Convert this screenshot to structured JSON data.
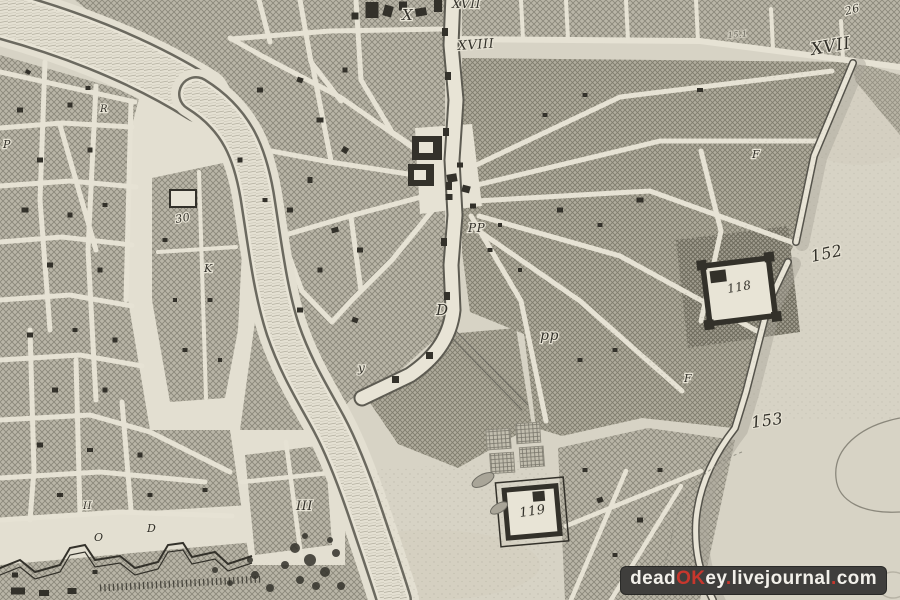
{
  "map": {
    "labels": [
      {
        "text": "X",
        "x": 402,
        "y": 20,
        "size": 15,
        "rot": 0
      },
      {
        "text": "XVII",
        "x": 452,
        "y": 8,
        "size": 12,
        "rot": 0
      },
      {
        "text": "XVIII",
        "x": 458,
        "y": 50,
        "size": 13,
        "rot": -4
      },
      {
        "text": "XVII",
        "x": 812,
        "y": 55,
        "size": 17,
        "rot": -10
      },
      {
        "text": "26",
        "x": 846,
        "y": 15,
        "size": 11,
        "rot": -15
      },
      {
        "text": "15.1",
        "x": 728,
        "y": 38,
        "size": 8,
        "rot": -5,
        "op": 0.55
      },
      {
        "text": "152",
        "x": 812,
        "y": 262,
        "size": 16,
        "rot": -12
      },
      {
        "text": "153",
        "x": 752,
        "y": 428,
        "size": 16,
        "rot": -8
      },
      {
        "text": "118",
        "x": 728,
        "y": 293,
        "size": 12,
        "rot": -10
      },
      {
        "text": "119",
        "x": 520,
        "y": 517,
        "size": 13,
        "rot": -8
      },
      {
        "text": "III",
        "x": 296,
        "y": 510,
        "size": 13,
        "rot": 0
      },
      {
        "text": "D",
        "x": 436,
        "y": 315,
        "size": 15,
        "rot": 0
      },
      {
        "text": "pp",
        "x": 540,
        "y": 340,
        "size": 14,
        "rot": 0
      },
      {
        "text": "PP",
        "x": 468,
        "y": 232,
        "size": 12,
        "rot": 0
      },
      {
        "text": "30",
        "x": 176,
        "y": 223,
        "size": 11,
        "rot": -10
      },
      {
        "text": "K",
        "x": 204,
        "y": 272,
        "size": 11,
        "rot": 0
      },
      {
        "text": "R",
        "x": 100,
        "y": 112,
        "size": 10,
        "rot": 0
      },
      {
        "text": "y",
        "x": 358,
        "y": 372,
        "size": 12,
        "rot": 0
      },
      {
        "text": "O",
        "x": 94,
        "y": 541,
        "size": 11,
        "rot": 0
      },
      {
        "text": "D",
        "x": 147,
        "y": 532,
        "size": 11,
        "rot": 0
      },
      {
        "text": "II",
        "x": 83,
        "y": 509,
        "size": 10,
        "rot": 0
      },
      {
        "text": "P",
        "x": 3,
        "y": 148,
        "size": 11,
        "rot": 0
      },
      {
        "text": "F",
        "x": 752,
        "y": 158,
        "size": 11,
        "rot": 0
      },
      {
        "text": "F",
        "x": 684,
        "y": 382,
        "size": 11,
        "rot": 0
      }
    ],
    "buildings": [
      [
        372,
        10,
        13,
        16,
        0
      ],
      [
        388,
        11,
        9,
        11,
        15
      ],
      [
        403,
        6,
        8,
        9,
        0
      ],
      [
        421,
        12,
        11,
        8,
        -10
      ],
      [
        355,
        16,
        7,
        7,
        0
      ],
      [
        438,
        6,
        8,
        12,
        0
      ],
      [
        300,
        80,
        6,
        5,
        20
      ],
      [
        320,
        120,
        7,
        5,
        0
      ],
      [
        345,
        150,
        6,
        6,
        30
      ],
      [
        310,
        180,
        5,
        6,
        0
      ],
      [
        290,
        210,
        6,
        5,
        0
      ],
      [
        335,
        230,
        7,
        5,
        -15
      ],
      [
        360,
        250,
        6,
        5,
        0
      ],
      [
        320,
        270,
        5,
        5,
        0
      ],
      [
        345,
        70,
        5,
        5,
        0
      ],
      [
        260,
        90,
        6,
        5,
        0
      ],
      [
        240,
        160,
        5,
        5,
        0
      ],
      [
        265,
        200,
        5,
        4,
        0
      ],
      [
        300,
        310,
        6,
        5,
        0
      ],
      [
        355,
        320,
        6,
        5,
        20
      ],
      [
        452,
        178,
        10,
        8,
        -10
      ],
      [
        466,
        189,
        8,
        7,
        15
      ],
      [
        449,
        197,
        7,
        6,
        0
      ],
      [
        473,
        206,
        6,
        5,
        0
      ],
      [
        460,
        165,
        6,
        5,
        0
      ],
      [
        20,
        110,
        6,
        5,
        0
      ],
      [
        70,
        105,
        5,
        5,
        0
      ],
      [
        40,
        160,
        6,
        5,
        0
      ],
      [
        90,
        150,
        5,
        5,
        0
      ],
      [
        25,
        210,
        7,
        5,
        0
      ],
      [
        70,
        215,
        5,
        5,
        0
      ],
      [
        105,
        205,
        5,
        4,
        0
      ],
      [
        50,
        265,
        6,
        5,
        0
      ],
      [
        100,
        270,
        5,
        5,
        0
      ],
      [
        30,
        335,
        6,
        5,
        0
      ],
      [
        75,
        330,
        5,
        4,
        0
      ],
      [
        115,
        340,
        5,
        5,
        0
      ],
      [
        55,
        390,
        6,
        5,
        0
      ],
      [
        105,
        390,
        5,
        5,
        0
      ],
      [
        40,
        445,
        6,
        5,
        0
      ],
      [
        90,
        450,
        6,
        4,
        0
      ],
      [
        140,
        455,
        5,
        5,
        0
      ],
      [
        60,
        495,
        6,
        4,
        0
      ],
      [
        150,
        495,
        5,
        4,
        0
      ],
      [
        205,
        490,
        5,
        4,
        0
      ],
      [
        28,
        72,
        5,
        4,
        30
      ],
      [
        88,
        88,
        5,
        4,
        0
      ],
      [
        490,
        250,
        5,
        4,
        0
      ],
      [
        520,
        270,
        4,
        4,
        0
      ],
      [
        500,
        225,
        4,
        4,
        0
      ],
      [
        560,
        210,
        6,
        5,
        0
      ],
      [
        600,
        225,
        5,
        4,
        0
      ],
      [
        585,
        95,
        5,
        4,
        0
      ],
      [
        640,
        200,
        7,
        5,
        0
      ],
      [
        615,
        350,
        5,
        4,
        0
      ],
      [
        580,
        360,
        5,
        4,
        0
      ],
      [
        545,
        115,
        5,
        4,
        0
      ],
      [
        700,
        90,
        6,
        4,
        0
      ],
      [
        165,
        240,
        5,
        4,
        0
      ],
      [
        210,
        300,
        5,
        4,
        0
      ],
      [
        185,
        350,
        5,
        4,
        0
      ],
      [
        220,
        360,
        4,
        4,
        0
      ],
      [
        175,
        300,
        4,
        4,
        0
      ],
      [
        600,
        500,
        6,
        5,
        -20
      ],
      [
        640,
        520,
        6,
        5,
        0
      ],
      [
        615,
        555,
        5,
        4,
        0
      ],
      [
        585,
        470,
        5,
        4,
        0
      ],
      [
        660,
        470,
        5,
        4,
        0
      ],
      [
        15,
        575,
        6,
        5,
        0
      ],
      [
        95,
        572,
        5,
        4,
        0
      ],
      [
        18,
        591,
        14,
        7,
        0
      ],
      [
        44,
        593,
        10,
        6,
        0
      ],
      [
        72,
        591,
        9,
        6,
        0
      ]
    ],
    "trees": [
      [
        295,
        548,
        5
      ],
      [
        310,
        560,
        6
      ],
      [
        325,
        572,
        5
      ],
      [
        300,
        580,
        4
      ],
      [
        285,
        565,
        4
      ],
      [
        336,
        553,
        4
      ],
      [
        316,
        586,
        4
      ],
      [
        341,
        586,
        4
      ],
      [
        255,
        575,
        4
      ],
      [
        270,
        588,
        4
      ],
      [
        230,
        583,
        3
      ],
      [
        215,
        570,
        3
      ],
      [
        250,
        560,
        3
      ],
      [
        305,
        536,
        3
      ],
      [
        330,
        540,
        3
      ]
    ],
    "colors": {
      "paper": "#d7d3c5",
      "ink": "#33312a",
      "street": "#e6e2d4",
      "watermark_bg": "#3f3e3c",
      "watermark_accent": "#c8372d",
      "watermark_text": "#f2f0ea"
    },
    "watermark": {
      "segments": [
        {
          "text": "dead",
          "accent": false
        },
        {
          "text": "OK",
          "accent": true
        },
        {
          "text": "ey",
          "accent": false
        },
        {
          "text": ".",
          "accent": true
        },
        {
          "text": "livejournal",
          "accent": false
        },
        {
          "text": ".",
          "accent": true
        },
        {
          "text": "com",
          "accent": false
        }
      ]
    }
  }
}
